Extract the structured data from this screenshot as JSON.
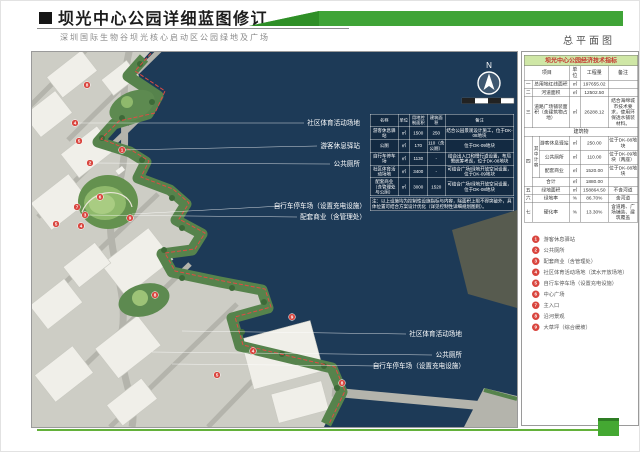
{
  "header": {
    "block_icon": "■",
    "title": "坝光中心公园详细蓝图修订",
    "subtitle": "深圳国际生物谷坝光核心启动区公园绿地及广场",
    "sheet_label": "总平面图"
  },
  "map": {
    "compass": "N",
    "labels": [
      "社区体育活动场地",
      "游客休息驿站",
      "公共厕所",
      "自行车停车场（设置充电设施）",
      "配套商业（含管理处）",
      "社区体育活动场地",
      "公共厕所",
      "自行车停车场（设置充电设施）"
    ],
    "markers": [
      "8",
      "4",
      "5",
      "1",
      "2",
      "6",
      "7",
      "3",
      "5",
      "9",
      "4",
      "8",
      "9",
      "4",
      "5",
      "8"
    ],
    "overlay_table": {
      "headers": [
        "名称",
        "单位",
        "用地控制面积",
        "建筑面积",
        "备注"
      ],
      "rows": [
        {
          "name": "游客休息驿站",
          "unit": "㎡",
          "area": "1500",
          "build": "250",
          "note": "结合公园景观设计施工，位于DK-08地块"
        },
        {
          "name": "公厕",
          "unit": "㎡",
          "area": "170",
          "build": "110（含公厕）",
          "note": "位于DK-09地块"
        },
        {
          "name": "自行车停车场",
          "unit": "㎡",
          "area": "1130",
          "build": "-",
          "note": "结合出入口和慢行道设置，布局需统筹考虑，位于DK-08地块"
        },
        {
          "name": "社区体育活动场地",
          "unit": "㎡",
          "area": "3400",
          "build": "-",
          "note": "可结合广场/绿地开放空间设置，位于DK-09地块"
        },
        {
          "name": "配套商业（含管理处与公厕）",
          "unit": "㎡",
          "area": "3000",
          "build": "1520",
          "note": "可结合广场/绿地开放空间设置，位于DK-08地块"
        }
      ],
      "note": "注：以上设施均为控制性设施指标与内容，除面积上限不得突破外，具体位置可结合方案设计优化（详见控制性详细规划图则）。"
    }
  },
  "sidebar": {
    "table": {
      "title": "坝光中心公园经济技术指标",
      "col_item": "项目",
      "col_unit": "单位",
      "col_qty": "工程量",
      "col_note": "备注",
      "rows": {
        "r1": {
          "no": "一",
          "label": "总用地红线面积",
          "unit": "㎡",
          "qty": "197655.02",
          "note": ""
        },
        "r2": {
          "no": "二",
          "label": "河道面积",
          "unit": "㎡",
          "qty": "12502.50",
          "note": ""
        },
        "r3": {
          "no": "三",
          "label": "道路广场铺装面积（含建筑物占地）",
          "unit": "㎡",
          "qty": "26288.12",
          "note": "结合海绵城市技术要求，使用环保透水铺装材料。"
        },
        "section": "建筑物",
        "r4no": "四",
        "r4group": "其中计容",
        "r4a": {
          "label": "游客休息驿站",
          "unit": "㎡",
          "qty": "250.00",
          "note": "位于DK-08地块"
        },
        "r4b": {
          "label": "公共厕所",
          "unit": "㎡",
          "qty": "110.00",
          "note": "位于DK-09地块（两座）"
        },
        "r4c": {
          "label": "配套商业",
          "unit": "㎡",
          "qty": "1520.00",
          "note": "位于DK-08地块"
        },
        "r4d": {
          "label": "合计",
          "unit": "㎡",
          "qty": "1880.00",
          "note": ""
        },
        "r5": {
          "no": "五",
          "label": "绿地面积",
          "unit": "㎡",
          "qty": "158864.50",
          "note": "不含河道"
        },
        "r6": {
          "no": "六",
          "label": "绿地率",
          "unit": "%",
          "qty": "86.70%",
          "note": "含河道"
        },
        "r7": {
          "no": "七",
          "label": "硬化率",
          "unit": "%",
          "qty": "13.30%",
          "note": "含道路、广场铺装、建筑覆盖"
        }
      }
    },
    "legend": {
      "items": [
        {
          "num": "1",
          "label": "游客休息驿站"
        },
        {
          "num": "2",
          "label": "公共厕所"
        },
        {
          "num": "3",
          "label": "配套商业（含管理处）"
        },
        {
          "num": "4",
          "label": "社区体育活动场地（滨水开放场地）"
        },
        {
          "num": "5",
          "label": "自行车停车场（设置充电设施）"
        },
        {
          "num": "6",
          "label": "中心广场"
        },
        {
          "num": "7",
          "label": "主入口"
        },
        {
          "num": "8",
          "label": "沿河景观"
        },
        {
          "num": "9",
          "label": "大草坪（综合缓坡）"
        }
      ]
    }
  },
  "colors": {
    "accent_green": "#3fa437",
    "marker_red": "#d9453e",
    "water": "#1d3a57"
  }
}
